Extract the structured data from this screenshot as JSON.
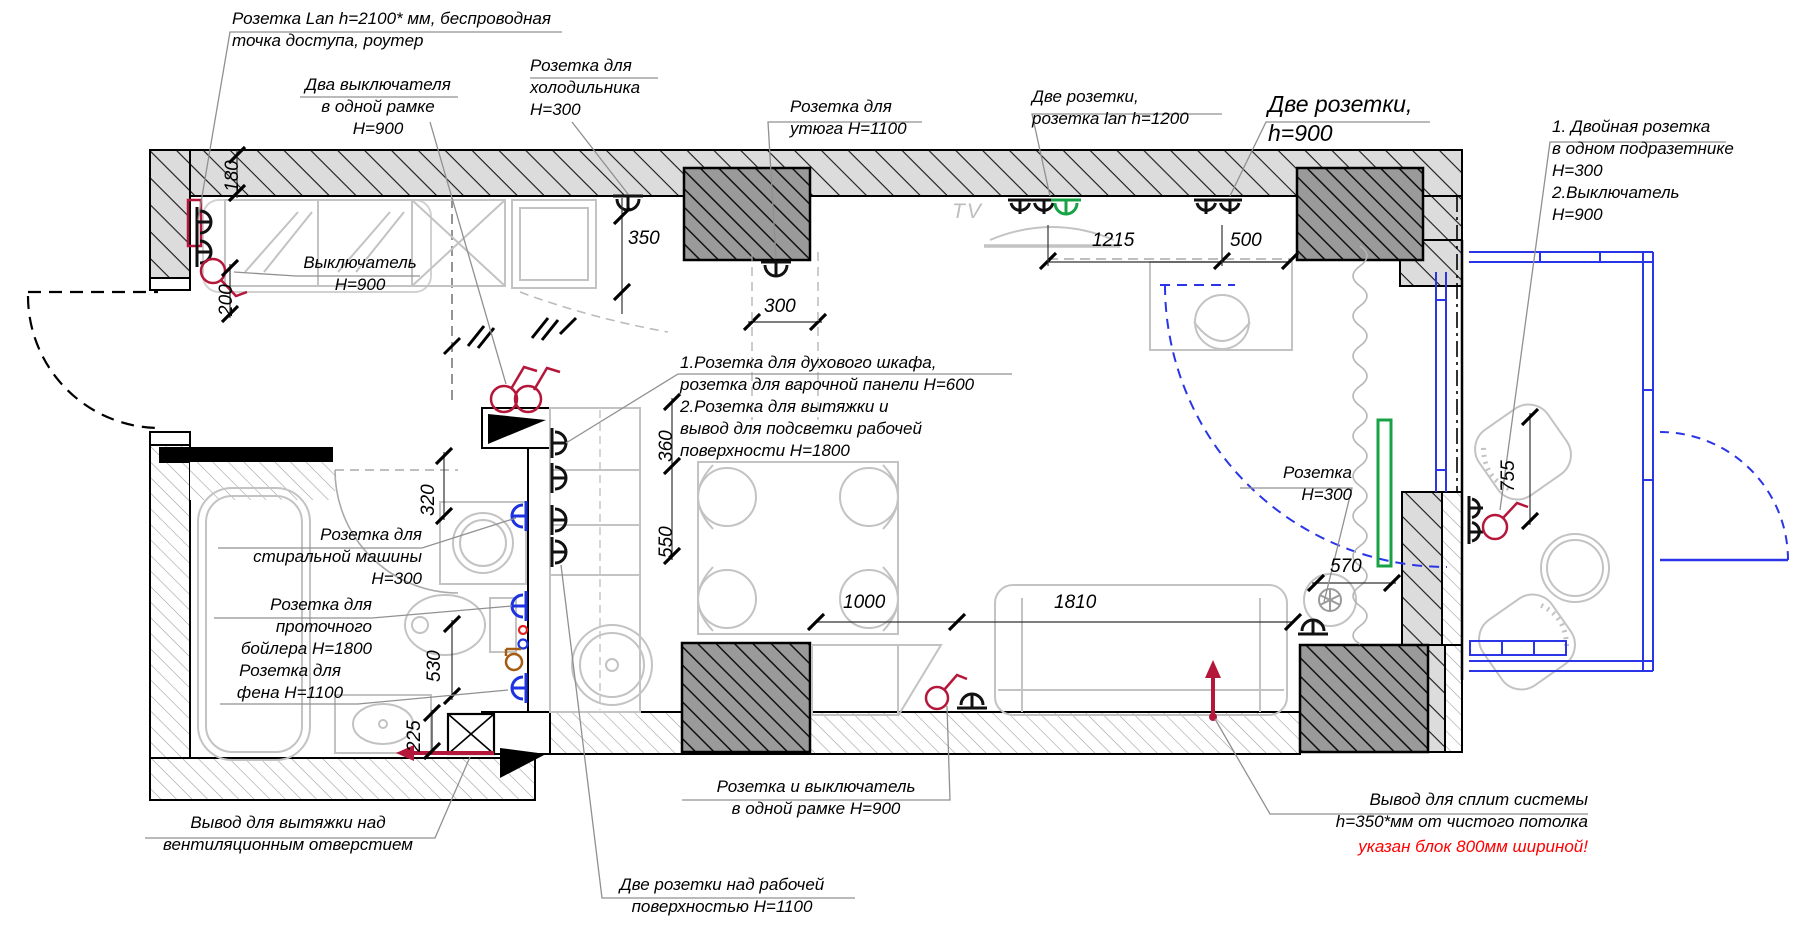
{
  "drawing": {
    "kind": "apartment electrical floor plan",
    "language": "ru"
  },
  "annotations": {
    "lan_router": "Розетка Lan h=2100* мм, беспроводная\nточка доступа, роутер",
    "two_switches": "Два выключателя\nв одной рамке H=900",
    "fridge": "Розетка для\nхолодильника\nH=300",
    "iron": "Розетка для\nутюга H=1100",
    "two_sockets_lan": "Две розетки,\nрозетка lan h=1200",
    "two_sockets_900": "Две розетки,\nh=900",
    "double_socket_switch": "1. Двойная розетка\nв одном подразетнике\nH=300\n2.Выключатель\nH=900",
    "switch_900": "Выключатель\nH=900",
    "oven_hood": "1.Розетка для духового шкафа,\nрозетка для варочной панели H=600\n2.Розетка для вытяжки  и\nвывод для подсветки рабочей\nповерхности H=1800",
    "socket_300": "Розетка\nH=300",
    "washing_machine": "Розетка для\nстиральной машины\nH=300",
    "boiler": "Розетка для\nпроточного\nбойлера H=1800",
    "hair_dryer": "Розетка для\nфена H=1100",
    "vent_hood": "Вывод для вытяжки над\nвентиляционным отверстием",
    "socket_switch_frame": "Розетка и выключатель\nв одной рамке H=900",
    "worktop_sockets": "Две розетки над рабочей\nповерхностью H=1100",
    "split_system": "Вывод для сплит системы\nh=350*мм от чистого потолка",
    "split_system_warning": "указан блок 800мм шириной!"
  },
  "labels": {
    "tv": "TV"
  },
  "dimensions": {
    "d180": "180",
    "d200": "200",
    "d350": "350",
    "d300": "300",
    "d1215": "1215",
    "d500": "500",
    "d360": "360",
    "d550": "550",
    "d320": "320",
    "d530": "530",
    "d225": "225",
    "d1000": "1000",
    "d1810": "1810",
    "d570": "570",
    "d755": "755"
  },
  "colors": {
    "wall_hatch_fill": "#dcdcdc",
    "shaft_fill": "#9a9a9a",
    "furniture_gray": "#c3c3c3",
    "symbol_black": "#111111",
    "symbol_red": "#b5173a",
    "warning_red": "#ff0000",
    "wet_zone_blue": "#1d32e0",
    "balcony_blue": "#2a35e8",
    "lan_green": "#17a345",
    "boiler_brown": "#a35c12"
  }
}
